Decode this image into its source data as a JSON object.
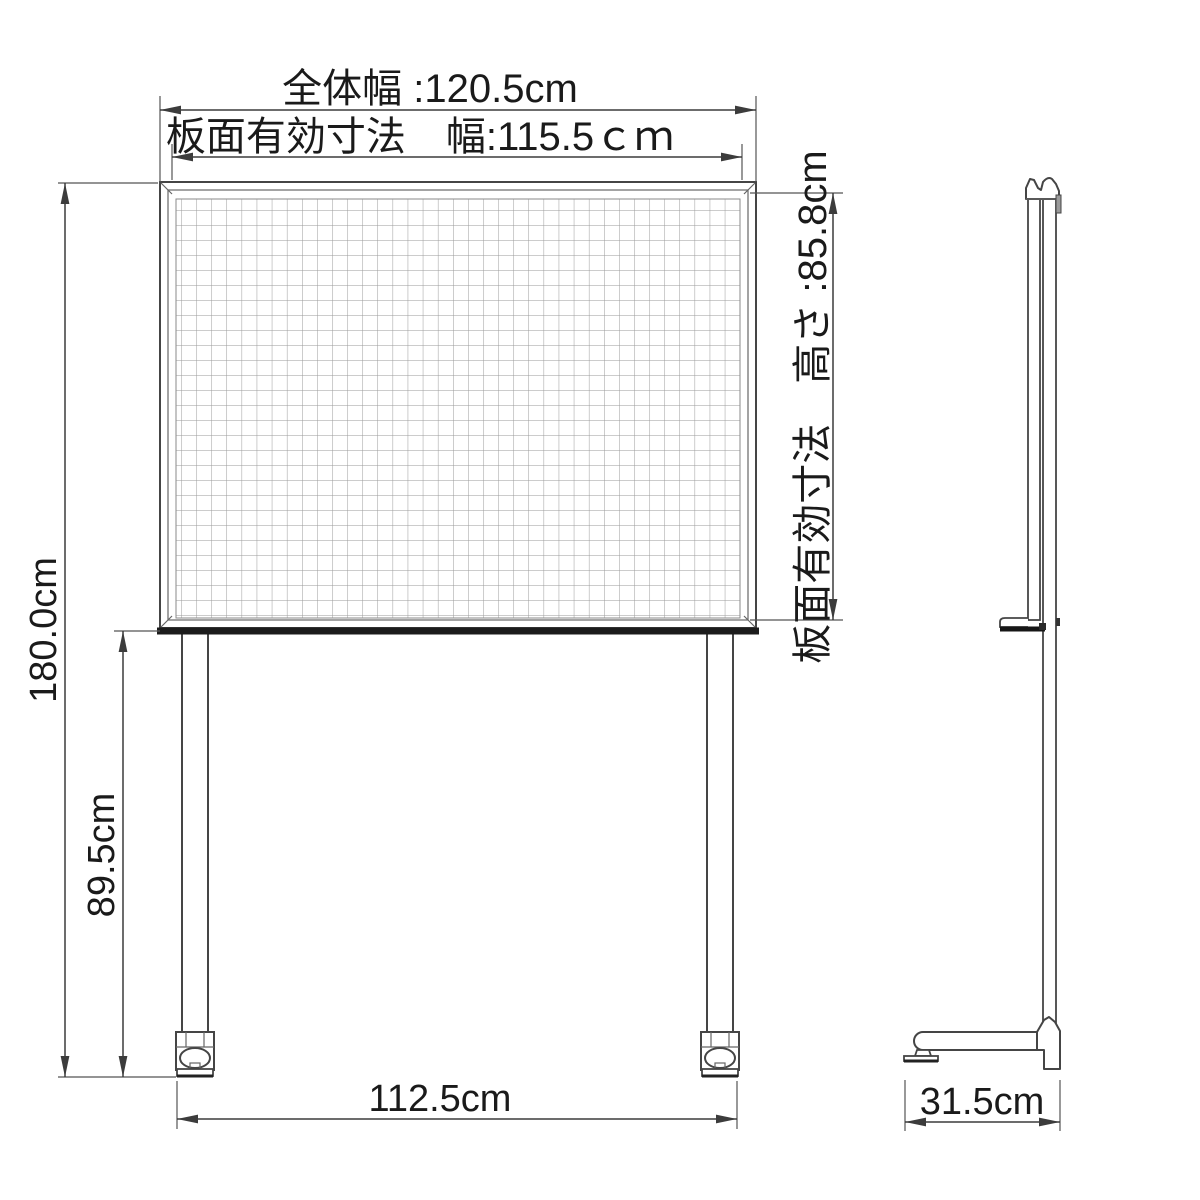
{
  "title": "ホワイトボード寸法図",
  "colors": {
    "line": "#454545",
    "grid_line": "#9a9a9a",
    "tray": "#1c1c1c",
    "background": "#ffffff",
    "text": "#1a1a1a"
  },
  "dimensions": {
    "overall_width_label": "全体幅 :120.5cm",
    "board_face_width_label": "板面有効寸法　幅:115.5ｃｍ",
    "board_face_height_label": "板面有効寸法　高さ :85.8cm",
    "overall_height_label": "180.0cm",
    "board_bottom_height_label": "89.5cm",
    "leg_span_label": "112.5cm",
    "base_depth_label": "31.5cm"
  },
  "values": {
    "overall_width_cm": 120.5,
    "board_face_width_cm": 115.5,
    "board_face_height_cm": 85.8,
    "overall_height_cm": 180.0,
    "board_bottom_height_cm": 89.5,
    "leg_span_cm": 112.5,
    "base_depth_cm": 31.5
  }
}
